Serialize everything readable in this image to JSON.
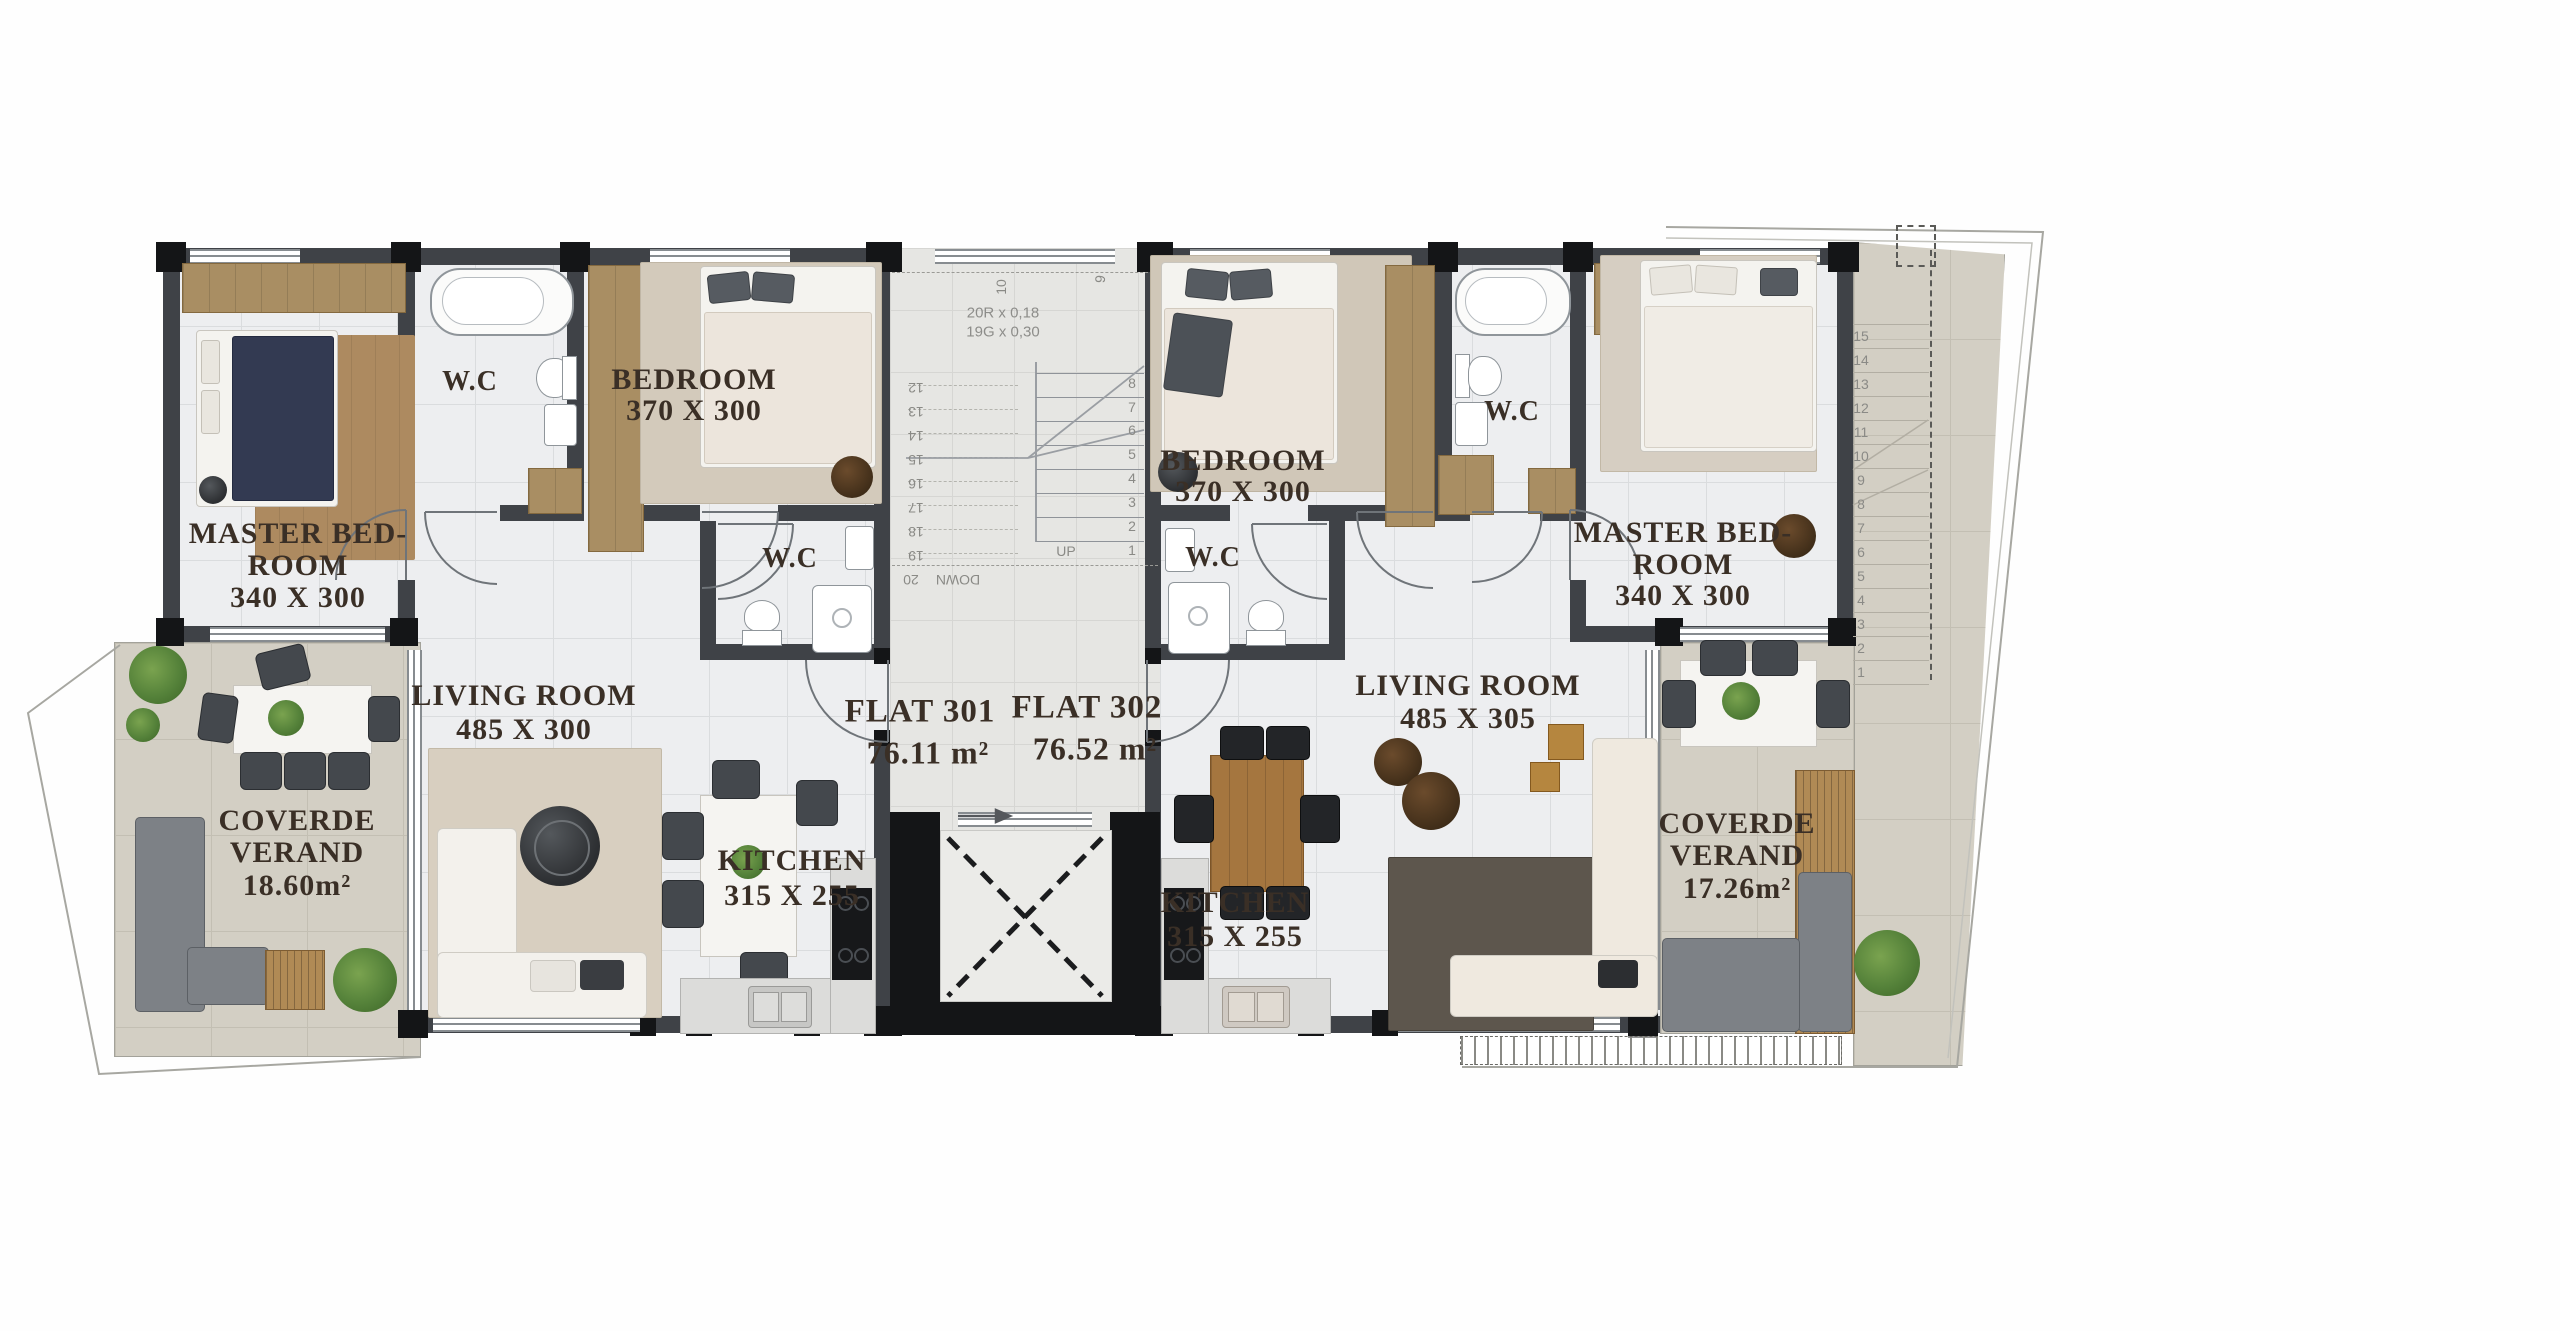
{
  "title": "Third floor plan — Flats 301 & 302",
  "rooms": {
    "left_master": {
      "l1": "MASTER BED-",
      "l2": "ROOM",
      "l3": "340 X 300"
    },
    "left_wc_top": {
      "l1": "W.C"
    },
    "left_bedroom": {
      "l1": "BEDROOM",
      "l2": "370 X 300"
    },
    "left_wc_mid": {
      "l1": "W.C"
    },
    "left_living": {
      "l1": "LIVING ROOM",
      "l2": "485 X 300"
    },
    "left_kitchen": {
      "l1": "KITCHEN",
      "l2": "315 X 255"
    },
    "left_veranda": {
      "l1": "COVERDE",
      "l2": "VERAND",
      "l3": "18.60m²"
    },
    "flat1": {
      "l1": "FLAT 301",
      "l2": "76.11 m²"
    },
    "flat2": {
      "l1": "FLAT 302",
      "l2": "76.52 m²"
    },
    "right_bedroom": {
      "l1": "BEDROOM",
      "l2": "370 X 300"
    },
    "right_wc_mid": {
      "l1": "W.C"
    },
    "right_wc_top": {
      "l1": "W.C"
    },
    "right_master": {
      "l1": "MASTER BED-",
      "l2": "ROOM",
      "l3": "340 X 300"
    },
    "right_living": {
      "l1": "LIVING ROOM",
      "l2": "485 X 305"
    },
    "right_kitchen": {
      "l1": "KITCHEN",
      "l2": "315 X 255"
    },
    "right_veranda": {
      "l1": "COVERDE",
      "l2": "VERAND",
      "l3": "17.26m²"
    }
  },
  "stairs": {
    "spec1": "20R x 0,18",
    "spec2": "19G x 0,30",
    "up": "UP",
    "down": "DOWN",
    "interior_up_numbers": [
      "1",
      "2",
      "3",
      "4",
      "5",
      "6",
      "7",
      "8"
    ],
    "interior_down_numbers": [
      "12",
      "13",
      "14",
      "15",
      "16",
      "17",
      "18",
      "19",
      "20"
    ],
    "upper_marks": [
      "9",
      "10"
    ],
    "exterior_numbers": [
      "1",
      "2",
      "3",
      "4",
      "5",
      "6",
      "7",
      "8",
      "9",
      "10",
      "11",
      "12",
      "13",
      "14",
      "15"
    ]
  },
  "colors": {
    "wall": "#3f4247",
    "pier": "#141517",
    "closet_wood": "#a98e63",
    "marble_floor": "#edeef0",
    "veranda_floor": "#d3cfc4",
    "terrace_floor": "#d7d3c8",
    "label_text": "#3a2f26",
    "plant_green": "#55823a",
    "table_wood": "#a5763f",
    "navy_blanket": "#333a52"
  }
}
